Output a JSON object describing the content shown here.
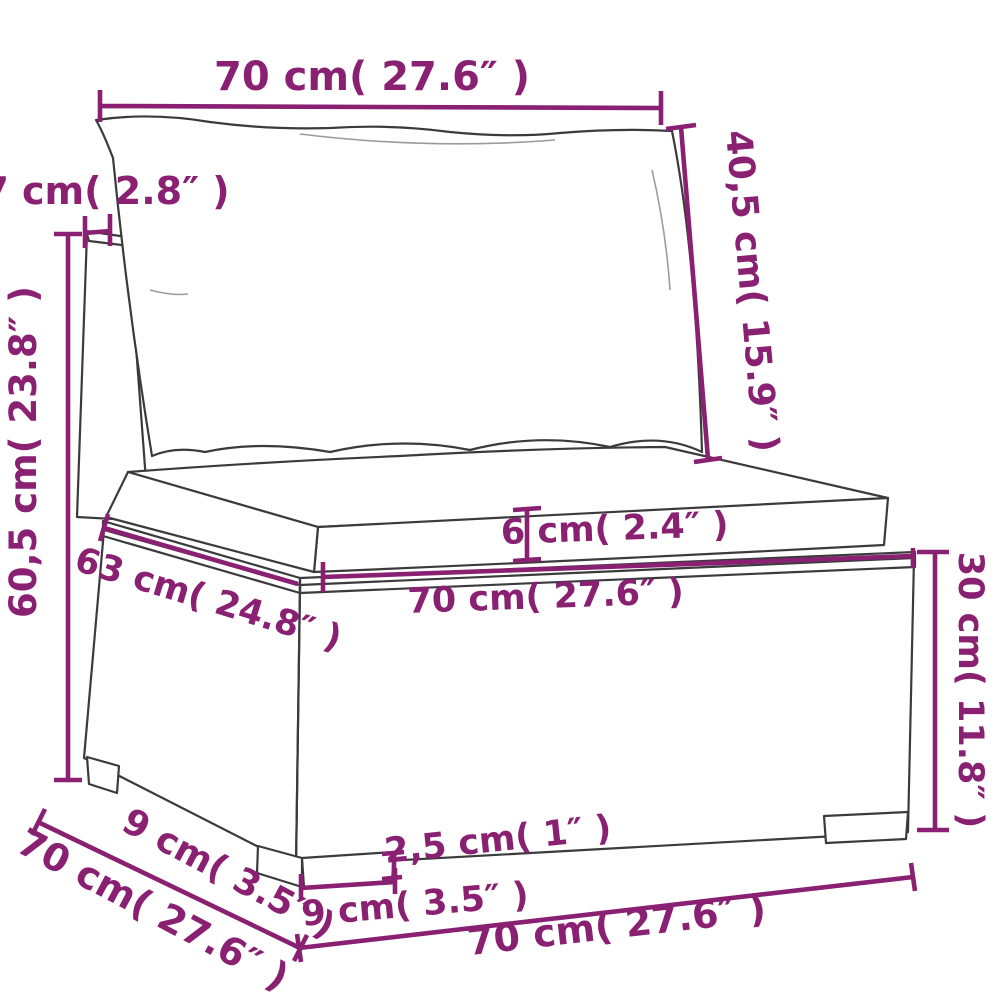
{
  "colors": {
    "accent": "#8A2072",
    "line": "#3B3B3D",
    "background": "#FFFFFF"
  },
  "labels": {
    "top_width": "70 cm( 27.6″ )",
    "back_cushion_height": "40,5 cm( 15.9″ )",
    "armrest_top_width": "7 cm( 2.8″ )",
    "total_height": "60,5 cm( 23.8″ )",
    "seat_depth": "63 cm( 24.8″ )",
    "seat_front_width": "70 cm( 27.6″ )",
    "seat_cushion_thickness": "6 cm( 2.4″ )",
    "base_height": "30 cm( 11.8″ )",
    "foot_depth": "9 cm( 3.5″ )",
    "base_depth": "70 cm( 27.6″ )",
    "foot_width": "9 cm( 3.5″ )",
    "foot_height": "2,5 cm( 1″ )",
    "base_bottom_width": "70 cm( 27.6″ )"
  }
}
